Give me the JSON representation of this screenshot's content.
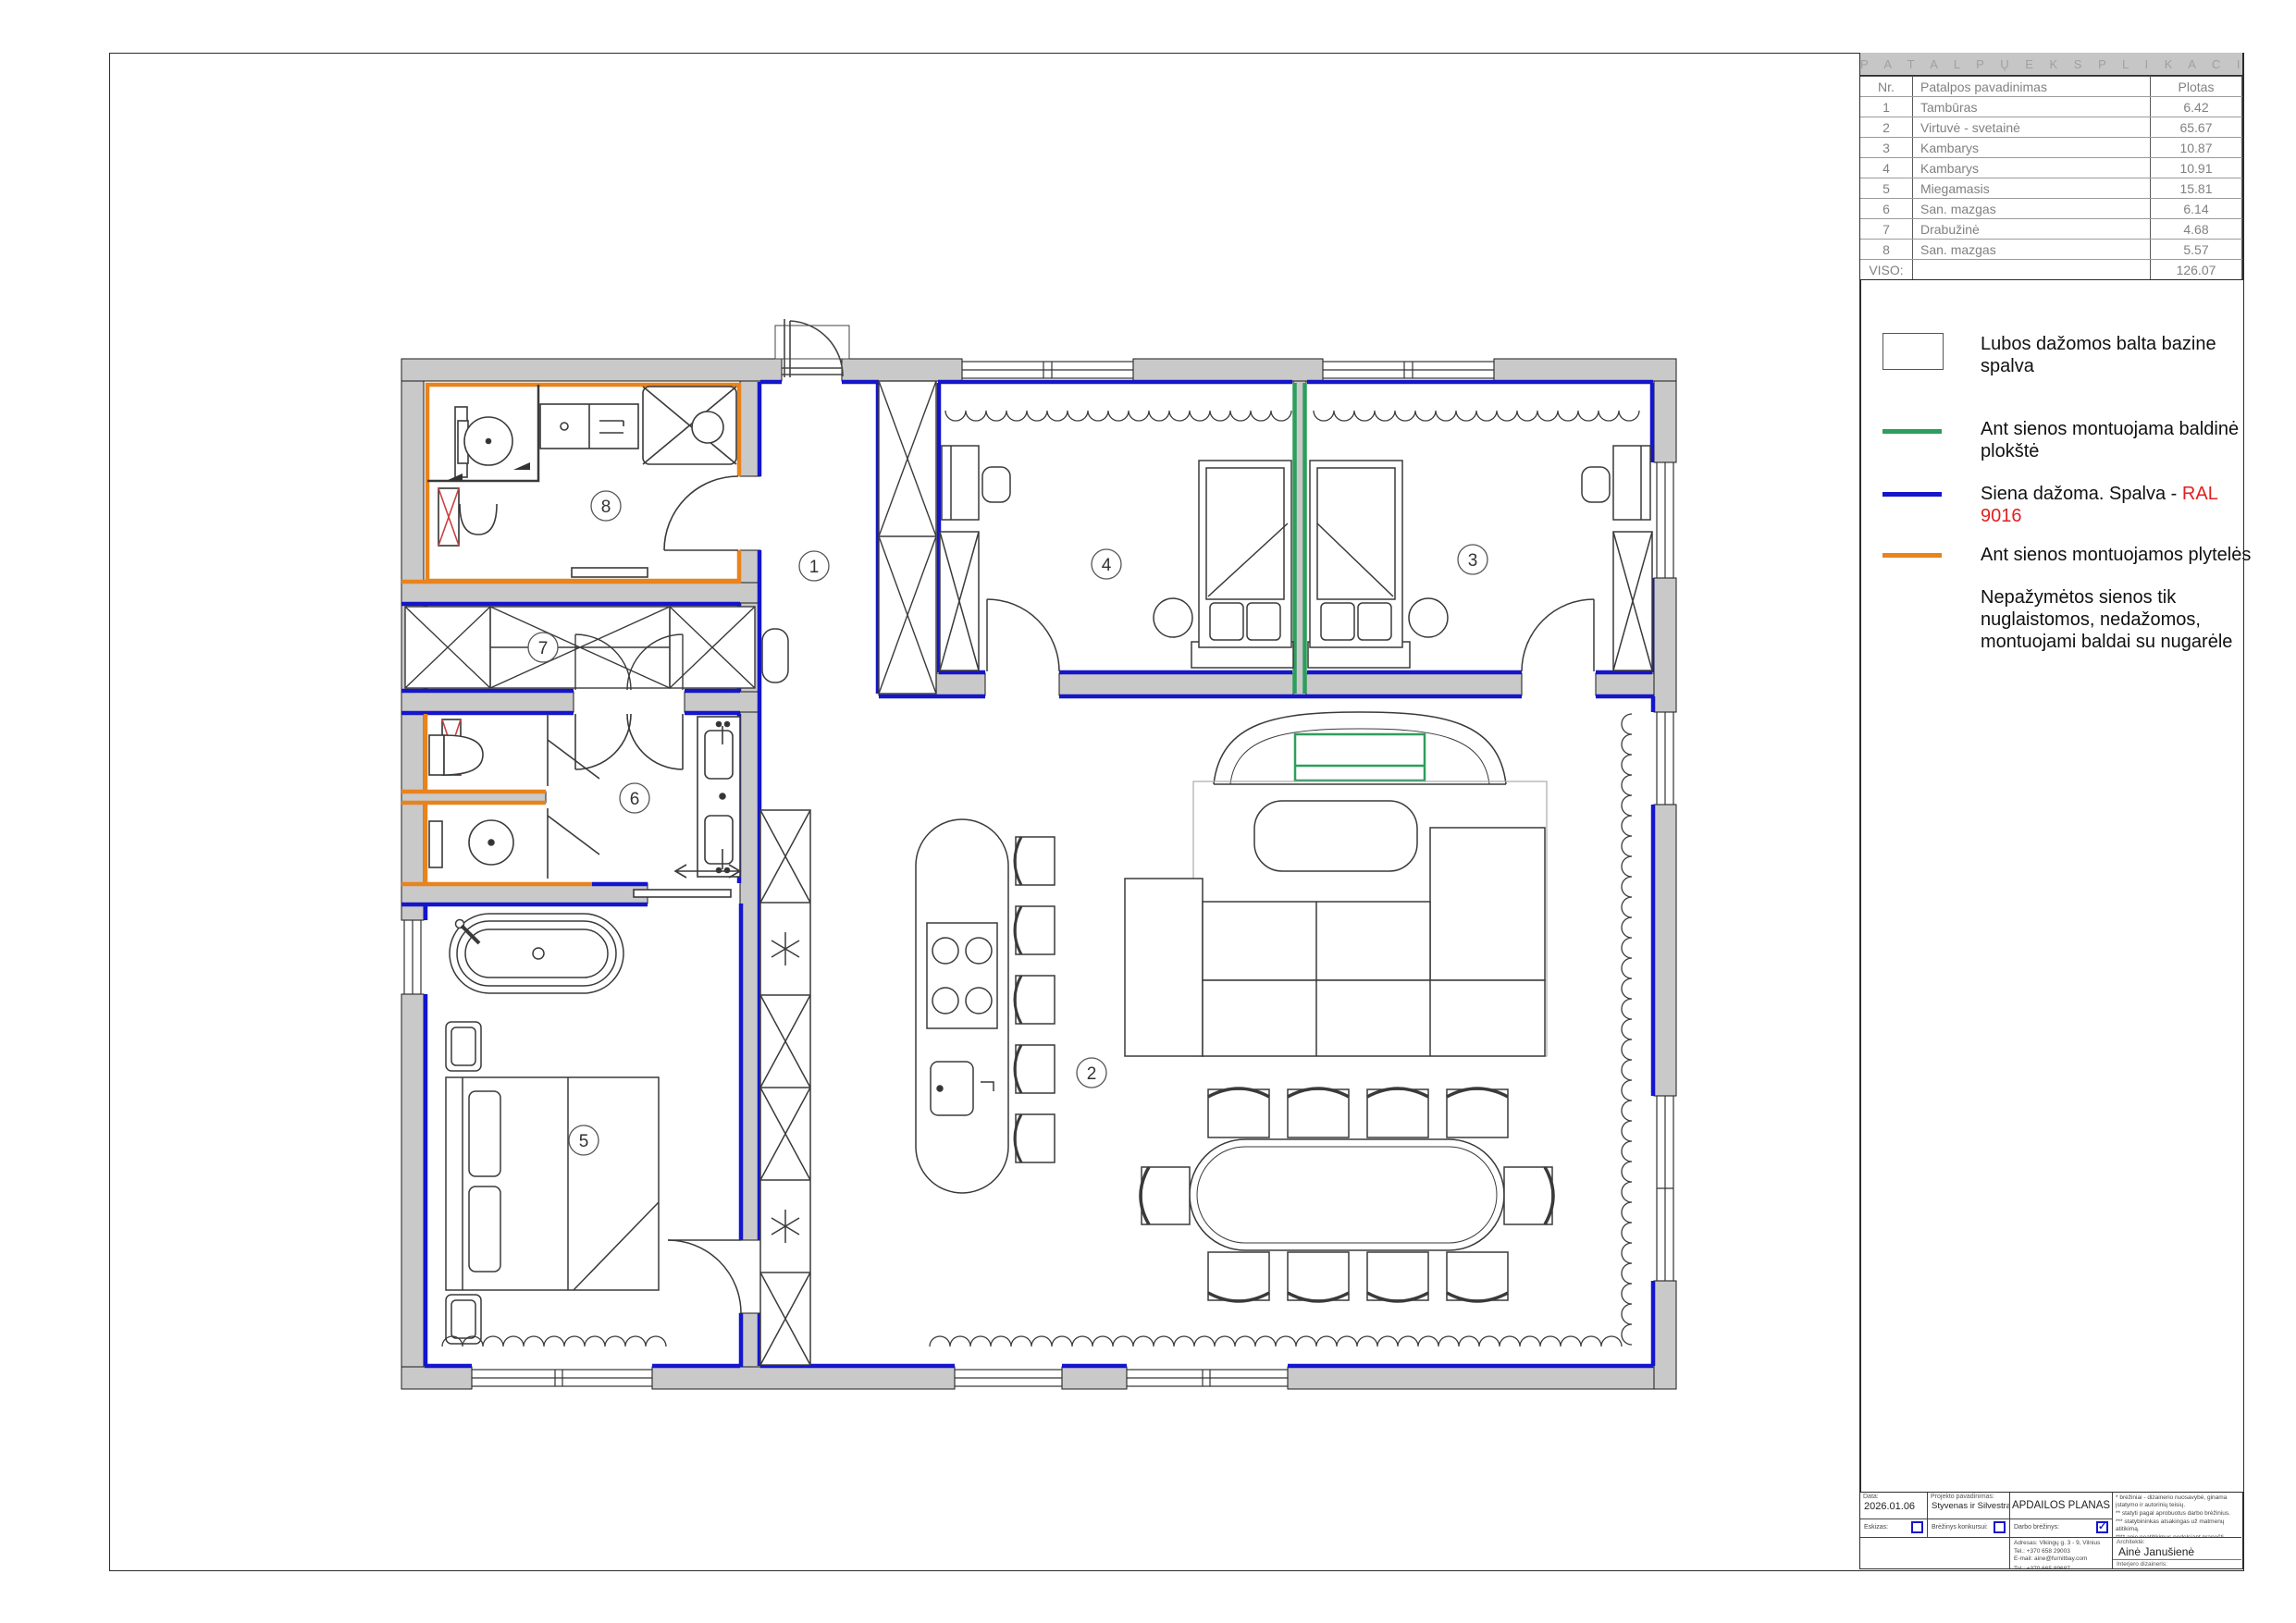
{
  "colors": {
    "wall_fill": "#c9c9c9",
    "painted_wall_blue": "#1515cc",
    "tiles_orange": "#e8831e",
    "furniture_panel_green": "#2e9e5c",
    "ral_text_red": "#e02020",
    "shaft_red": "#cc4040"
  },
  "explication": {
    "title": "P A T A L P Ų   E K S P L I K A C I J A",
    "headers": {
      "nr": "Nr.",
      "name": "Patalpos pavadinimas",
      "area": "Plotas"
    },
    "rows": [
      {
        "nr": "1",
        "name": "Tambūras",
        "area": "6.42"
      },
      {
        "nr": "2",
        "name": "Virtuvė - svetainė",
        "area": "65.67"
      },
      {
        "nr": "3",
        "name": "Kambarys",
        "area": "10.87"
      },
      {
        "nr": "4",
        "name": "Kambarys",
        "area": "10.91"
      },
      {
        "nr": "5",
        "name": "Miegamasis",
        "area": "15.81"
      },
      {
        "nr": "6",
        "name": "San. mazgas",
        "area": "6.14"
      },
      {
        "nr": "7",
        "name": "Drabužinė",
        "area": "4.68"
      },
      {
        "nr": "8",
        "name": "San. mazgas",
        "area": "5.57"
      }
    ],
    "total_label": "VISO:",
    "total": "126.07"
  },
  "legend": {
    "items": [
      {
        "swatch": "white-box",
        "label": "Lubos dažomos balta bazine spalva"
      },
      {
        "swatch": "green-line",
        "label": "Ant sienos montuojama baldinė plokštė"
      },
      {
        "swatch": "blue-line",
        "label": "Siena dažoma. Spalva - ",
        "highlight": "RAL 9016"
      },
      {
        "swatch": "orange-line",
        "label": "Ant sienos montuojamos plytelės"
      },
      {
        "swatch": "none",
        "label": "Nepažymėtos sienos tik nuglaistomos, nedažomos, montuojami baldai su nugarėle"
      }
    ]
  },
  "plan": {
    "markers": [
      {
        "label": "1"
      },
      {
        "label": "2"
      },
      {
        "label": "3"
      },
      {
        "label": "4"
      },
      {
        "label": "5"
      },
      {
        "label": "6"
      },
      {
        "label": "7"
      },
      {
        "label": "8"
      }
    ]
  },
  "titleblock": {
    "date_label": "Data:",
    "date": "2026.01.06",
    "project_label": "Projekto pavadinimas:",
    "project": "Styvenas ir Silvestras",
    "drawing_title": "APDAILOS PLANAS",
    "checks": [
      {
        "label": "Eskizas:",
        "mark": ""
      },
      {
        "label": "Brėžinys konkursui:",
        "mark": ""
      },
      {
        "label": "Darbo brėžinys:",
        "mark": "✓"
      }
    ],
    "notes": [
      "*  brėžiniai - dizainerio nuosavybė, ginama įstatymo ir autorinių teisių.",
      "**  statyti pagal aprobuotus darbo brėžinius.",
      "***  statybininkas atsakingas už matmenų atitikimą.",
      "****  apie neatitikimus nedelsiant pranešti projekto vadovui."
    ],
    "contact1": [
      "Adresas: Vikingų g. 3 - 9, Vilnius",
      "Tel.: +370 658 29003",
      "E-mail: aine@furnitbay.com"
    ],
    "contact2": [
      "Tel.: +370 665 89687",
      "E-mail: projektavimas@senanusisinterjeras.lt"
    ],
    "architect_label": "Architektė:",
    "architect": "Ainė Janušienė",
    "designer_label": "Interjero dizaineris:",
    "designer": "Faustas Jonas Povilaitis"
  }
}
